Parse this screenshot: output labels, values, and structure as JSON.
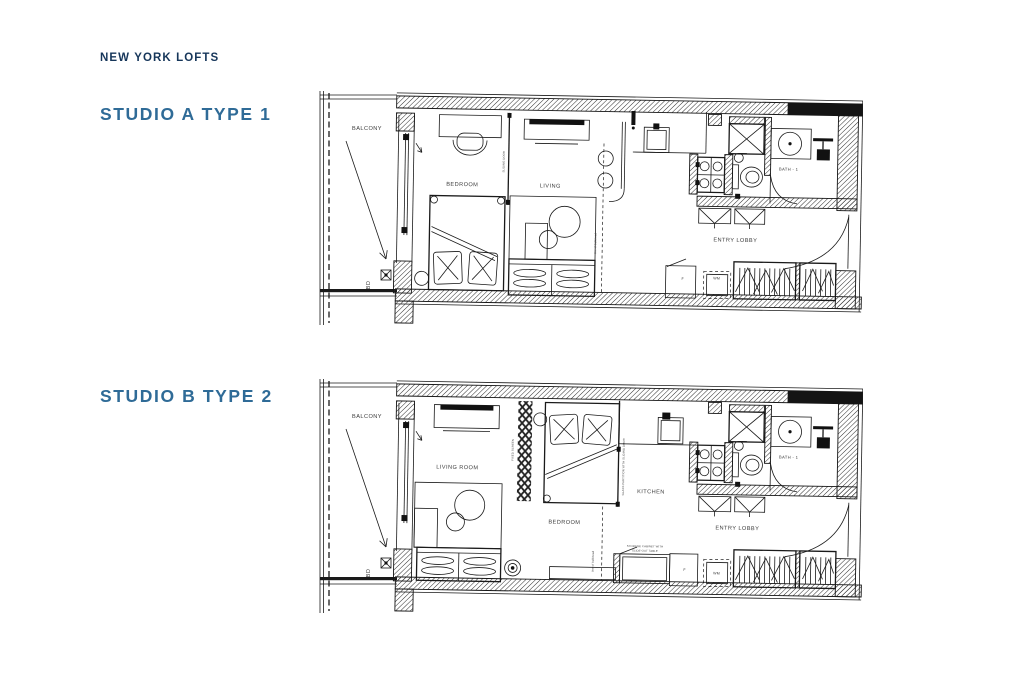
{
  "header": {
    "brand": "NEW YORK LOFTS"
  },
  "colors": {
    "brand_text": "#16365a",
    "title_text": "#2f6b97",
    "line": "#1a1a1a"
  },
  "plans": [
    {
      "title": "STUDIO A TYPE 1",
      "labels": {
        "balcony": "BALCONY",
        "bd": "BD",
        "bedroom": "BEDROOM",
        "living": "LIVING",
        "sliding_door": "SLIDING DOOR",
        "line_of_bulkhead": "line of bulkhead",
        "entry_lobby": "ENTRY LOBBY",
        "bath": "BATH - 1",
        "fridge": "F",
        "washer": "WM"
      }
    },
    {
      "title": "STUDIO B TYPE 2",
      "labels": {
        "balcony": "BALCONY",
        "bd": "BD",
        "living_room": "LIVING ROOM",
        "fixed_screen": "FIXED SCREEN",
        "bedroom": "BEDROOM",
        "kitchen": "KITCHEN",
        "glass_partition": "GLASS PARTITION WITH SLIDING DOOR",
        "storage_line1": "STORAGE CABINET WITH",
        "storage_line2": "SLIDE-OUT TABLE",
        "line_of_bulkhead": "line of bulkhead",
        "entry_lobby": "ENTRY LOBBY",
        "bath": "BATH - 1",
        "fridge": "F",
        "washer": "WM"
      }
    }
  ]
}
